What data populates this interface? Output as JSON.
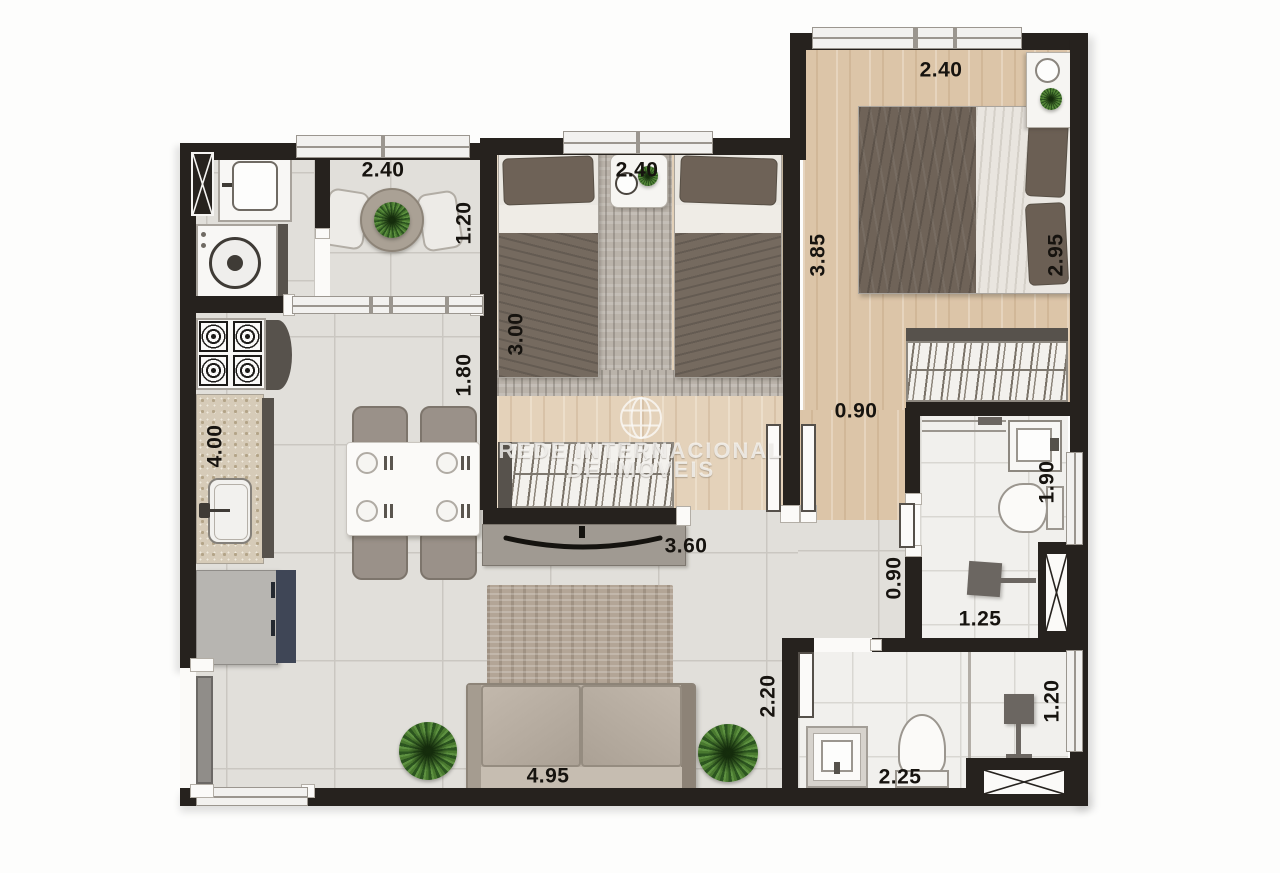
{
  "watermark": {
    "line1": "REDE INTERNACIONAL",
    "line2": "DE IMÓVEIS"
  },
  "dimensions": [
    {
      "id": "balcony-width",
      "text": "2.40",
      "x": 383,
      "y": 170,
      "orient": "h"
    },
    {
      "id": "balcony-depth",
      "text": "1.20",
      "x": 464,
      "y": 223,
      "orient": "v"
    },
    {
      "id": "bedroom2-width",
      "text": "2.40",
      "x": 637,
      "y": 170,
      "orient": "h"
    },
    {
      "id": "bedroom2-depth",
      "text": "3.00",
      "x": 516,
      "y": 334,
      "orient": "v"
    },
    {
      "id": "master-width",
      "text": "2.40",
      "x": 941,
      "y": 70,
      "orient": "h"
    },
    {
      "id": "master-depth-left",
      "text": "3.85",
      "x": 818,
      "y": 255,
      "orient": "v"
    },
    {
      "id": "master-depth-right",
      "text": "2.95",
      "x": 1056,
      "y": 255,
      "orient": "v"
    },
    {
      "id": "kitchen-passage",
      "text": "1.80",
      "x": 464,
      "y": 375,
      "orient": "v"
    },
    {
      "id": "kitchen-counter",
      "text": "4.00",
      "x": 215,
      "y": 446,
      "orient": "v"
    },
    {
      "id": "master-hall-width",
      "text": "0.90",
      "x": 856,
      "y": 411,
      "orient": "h"
    },
    {
      "id": "bath1-depth",
      "text": "1.90",
      "x": 1047,
      "y": 482,
      "orient": "v"
    },
    {
      "id": "tv-wall",
      "text": "3.60",
      "x": 686,
      "y": 546,
      "orient": "h"
    },
    {
      "id": "hall2-width",
      "text": "0.90",
      "x": 894,
      "y": 578,
      "orient": "v"
    },
    {
      "id": "bath1-shower-width",
      "text": "1.25",
      "x": 980,
      "y": 619,
      "orient": "h"
    },
    {
      "id": "living-depth",
      "text": "2.20",
      "x": 768,
      "y": 696,
      "orient": "v"
    },
    {
      "id": "bath2-shower-depth",
      "text": "1.20",
      "x": 1052,
      "y": 701,
      "orient": "v"
    },
    {
      "id": "bath2-width",
      "text": "2.25",
      "x": 900,
      "y": 777,
      "orient": "h"
    },
    {
      "id": "living-width",
      "text": "4.95",
      "x": 548,
      "y": 776,
      "orient": "h"
    }
  ],
  "palette": {
    "wall": "#26221e",
    "ink": "#16130f",
    "tile": "#e1dfda",
    "tile_line": "#cac7c1",
    "bath": "#f1f0ed",
    "bath_line": "#d9d7d2",
    "wood": "#dcc5a8",
    "wood_light": "#e4d2ba",
    "white": "#f8f7f5",
    "gray_fix": "#a8a39c"
  }
}
